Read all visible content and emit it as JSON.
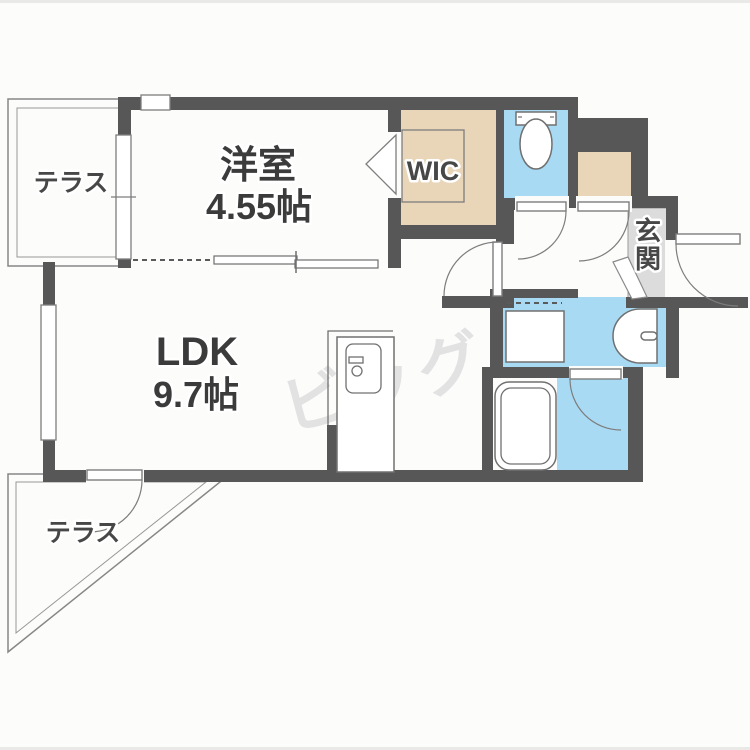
{
  "floorplan": {
    "labels": {
      "western_room": "洋室",
      "western_room_size": "4.55帖",
      "ldk": "LDK",
      "ldk_size": "9.7帖",
      "wic": "WIC",
      "entrance": "玄関",
      "entrance_chars": [
        "玄",
        "関"
      ],
      "terrace_top": "テラス",
      "terrace_bottom": "テラス",
      "watermark": "ビッグ"
    },
    "colors": {
      "wall": "#575757",
      "closet_fill": "#e9d6b8",
      "water_area_fill": "#a9daf3",
      "entrance_floor": "#dcdcdc",
      "line": "#7d7d7d",
      "watermark": "#e2e2e2",
      "background": "#fcfcfb"
    },
    "fixtures": [
      "toilet",
      "washbasin",
      "bathtub",
      "washer-space",
      "kitchen-unit"
    ]
  }
}
